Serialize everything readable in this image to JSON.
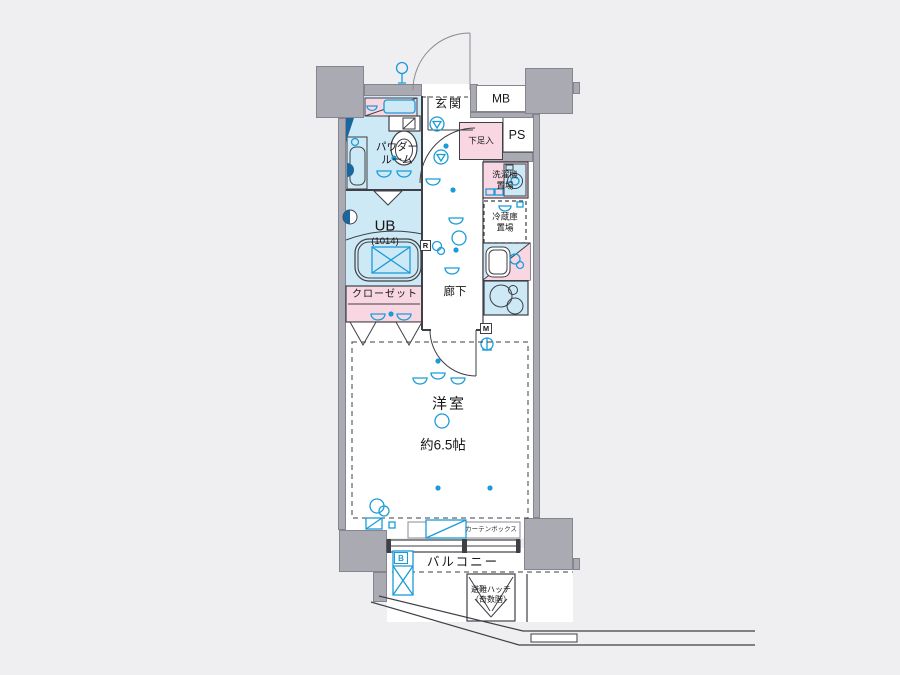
{
  "labels": {
    "genkan": "玄関",
    "mb": "MB",
    "ps": "PS",
    "shoe_box": "下足入",
    "washer_line1": "洗濯機",
    "washer_line2": "置場",
    "fridge_line1": "冷蔵庫",
    "fridge_line2": "置場",
    "powder_line1": "パウダー",
    "powder_line2": "ルーム",
    "ub": "UB",
    "ub_dim": "(1014)",
    "closet": "クローゼット",
    "hallway": "廊下",
    "western_room": "洋室",
    "western_room_size": "約6.5帖",
    "balcony": "バルコニー",
    "hatch_line1": "避難ハッチ",
    "hatch_line2": "（奇数階）",
    "curtain_box": "カーテンボックス",
    "chip_r": "R",
    "chip_m": "M",
    "chip_b": "B"
  },
  "colors": {
    "background": "#efeff1",
    "wall": "#aaaab3",
    "wet_area_fill": "#cde9f6",
    "storage_fill": "#f8d7e2",
    "symbol_blue": "#1b9cd8",
    "line": "#3f3f46"
  }
}
